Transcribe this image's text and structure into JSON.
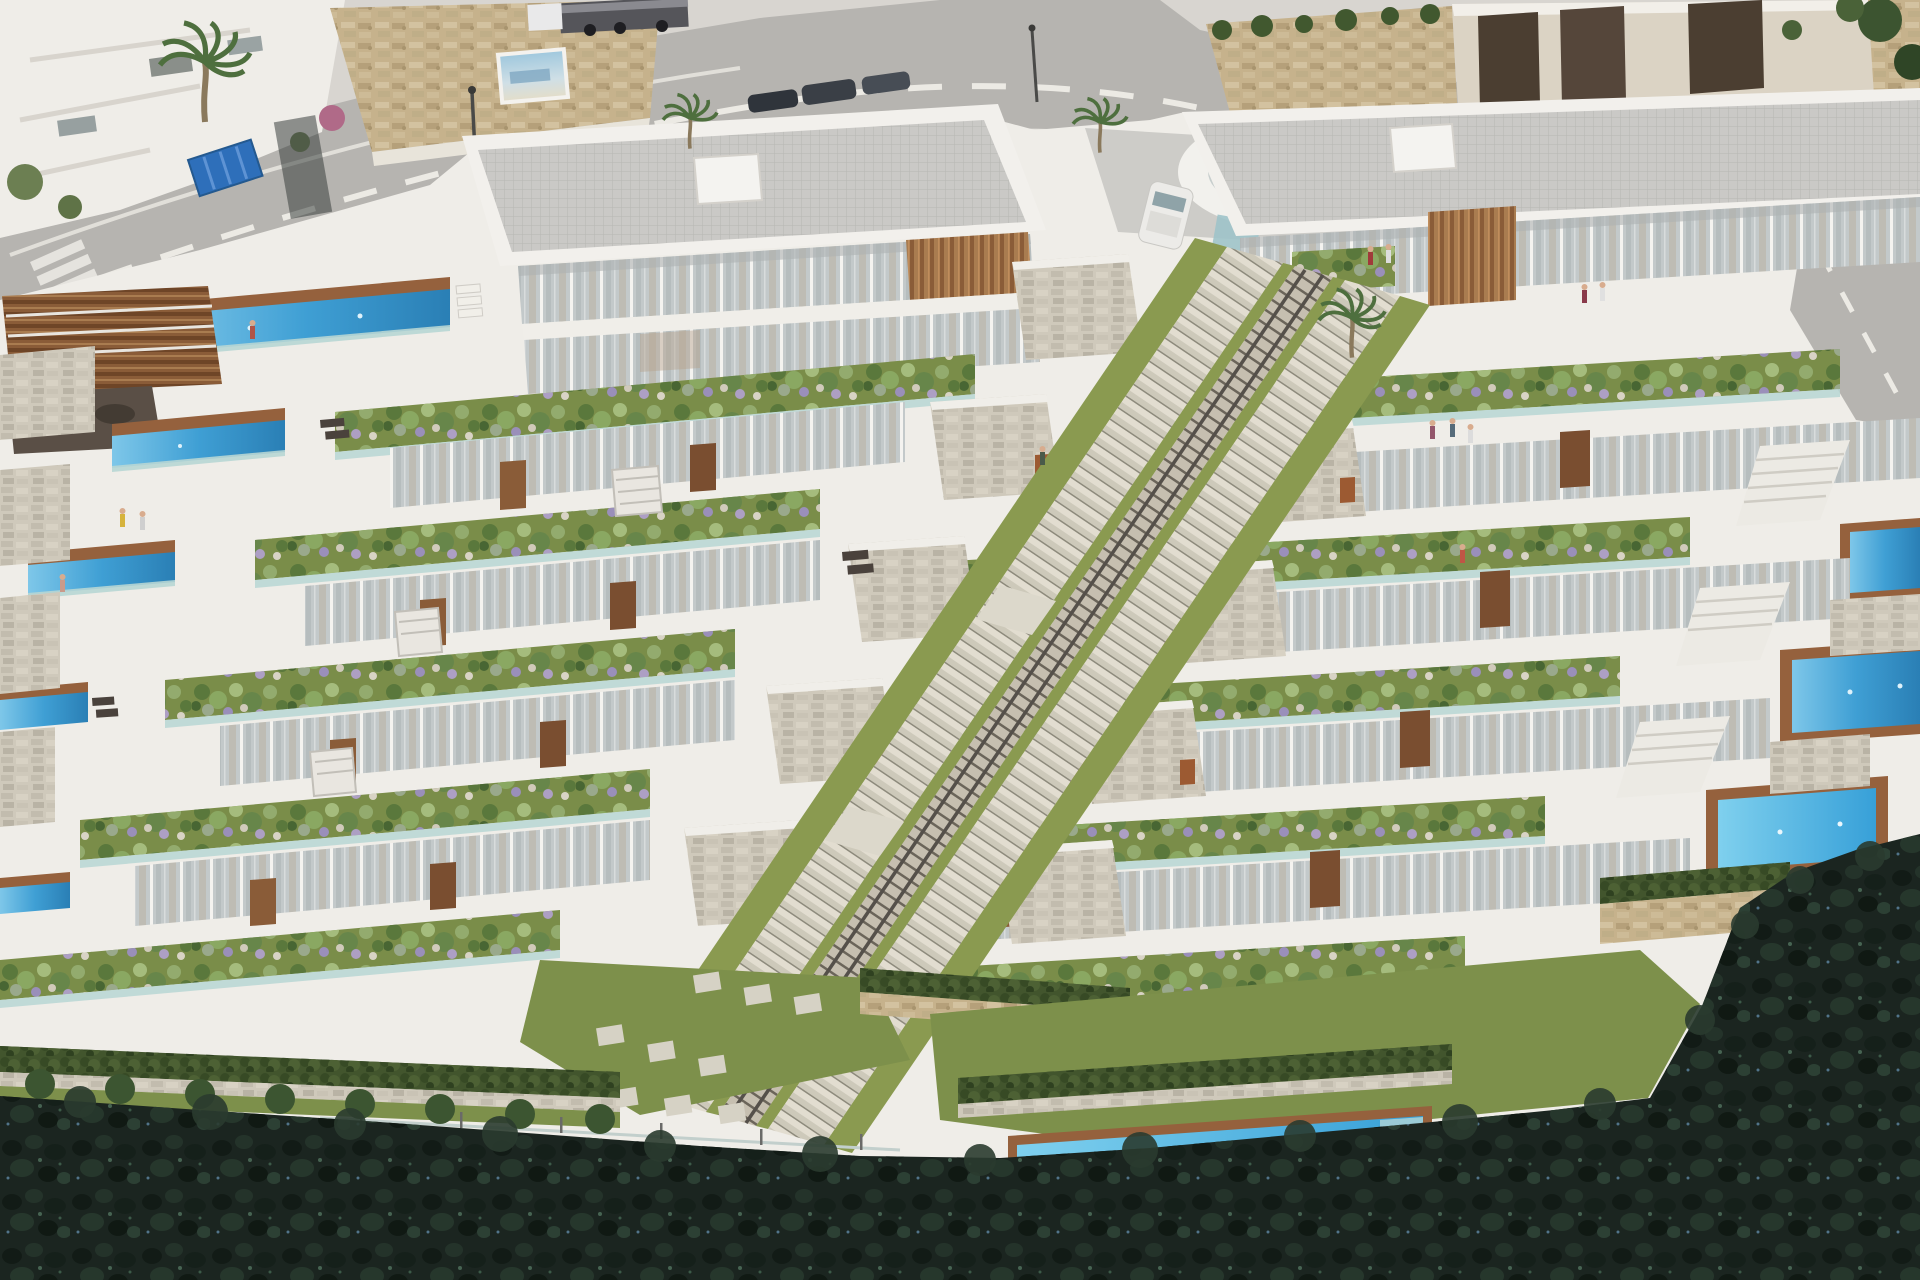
{
  "scene": {
    "type": "architectural-aerial-rendering",
    "subject": "terraced hillside apartment complex with private pools, central staircases, road and forest",
    "objects": [
      "road",
      "crosswalk",
      "lane-markings",
      "stone-retaining-walls",
      "billboard",
      "dumpster",
      "truck",
      "street-lamps",
      "parked-cars",
      "garage-block",
      "palm-trees",
      "white-villa",
      "oval-entrance-pavilion",
      "left-apartment-block",
      "right-apartment-block",
      "glass-facades",
      "wood-louvers",
      "terrace-planters",
      "private-pools",
      "central-staircase",
      "inclined-lift-rail",
      "stone-volumes",
      "communal-pool",
      "pool-loungers",
      "lawns",
      "hedges",
      "glass-fences",
      "stepping-stones",
      "pine-forest",
      "people"
    ]
  },
  "colors": {
    "white": "#efede8",
    "whiteBright": "#f7f6f2",
    "shadow": "#d9d6d0",
    "road": "#b6b4b0",
    "driveway": "#cdccc8",
    "marking": "#eceae4",
    "stoneTan": "#c6b28c",
    "stoneGray": "#cfc9bb",
    "roofGray": "#cac9c6",
    "glass": "#c3c9ca",
    "wood": "#95613d",
    "woodLight": "#b07c4e",
    "poolBlue": "#3f9fd4",
    "poolLight": "#7ec7e9",
    "aqua": "#b7d6d4",
    "planterGrass": "#7a8d49",
    "lawn": "#7d904b",
    "grassStrip": "#8a9a50",
    "bush": "#5a783c",
    "hedge": "#42552d",
    "forest": "#1b2520",
    "palm": "#4e6f3e",
    "trunk": "#8a795c",
    "canopy": "#3b3a41",
    "doorWood": "#8a5c38",
    "carTeal": "#7e949a",
    "dumpster": "#2e6fba",
    "truckDark": "#55555a"
  }
}
